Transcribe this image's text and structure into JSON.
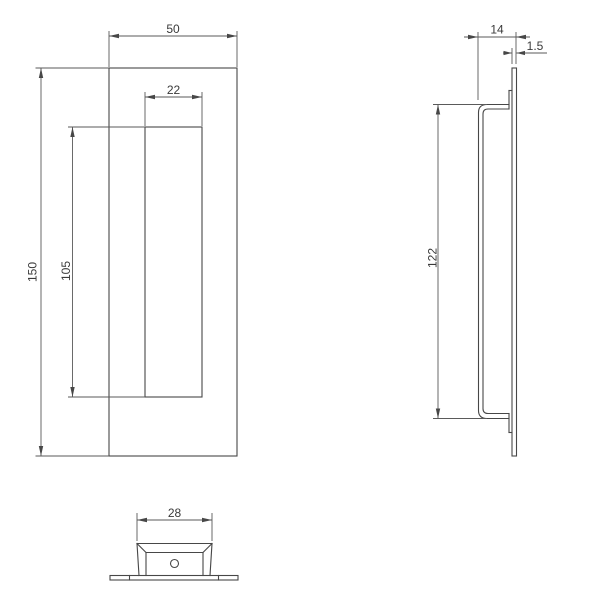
{
  "drawing": {
    "background_color": "#ffffff",
    "line_color": "#474747",
    "dimension_line_color": "#5a5a5a",
    "text_color": "#3a3a3a",
    "views": {
      "front": {
        "dims": {
          "outer_width": "50",
          "opening_width": "22",
          "outer_height": "150",
          "opening_height": "105"
        }
      },
      "side": {
        "dims": {
          "total_depth": "14",
          "plate_thickness": "1.5",
          "cup_height": "122"
        }
      },
      "bottom": {
        "dims": {
          "cup_width": "28"
        }
      }
    }
  }
}
